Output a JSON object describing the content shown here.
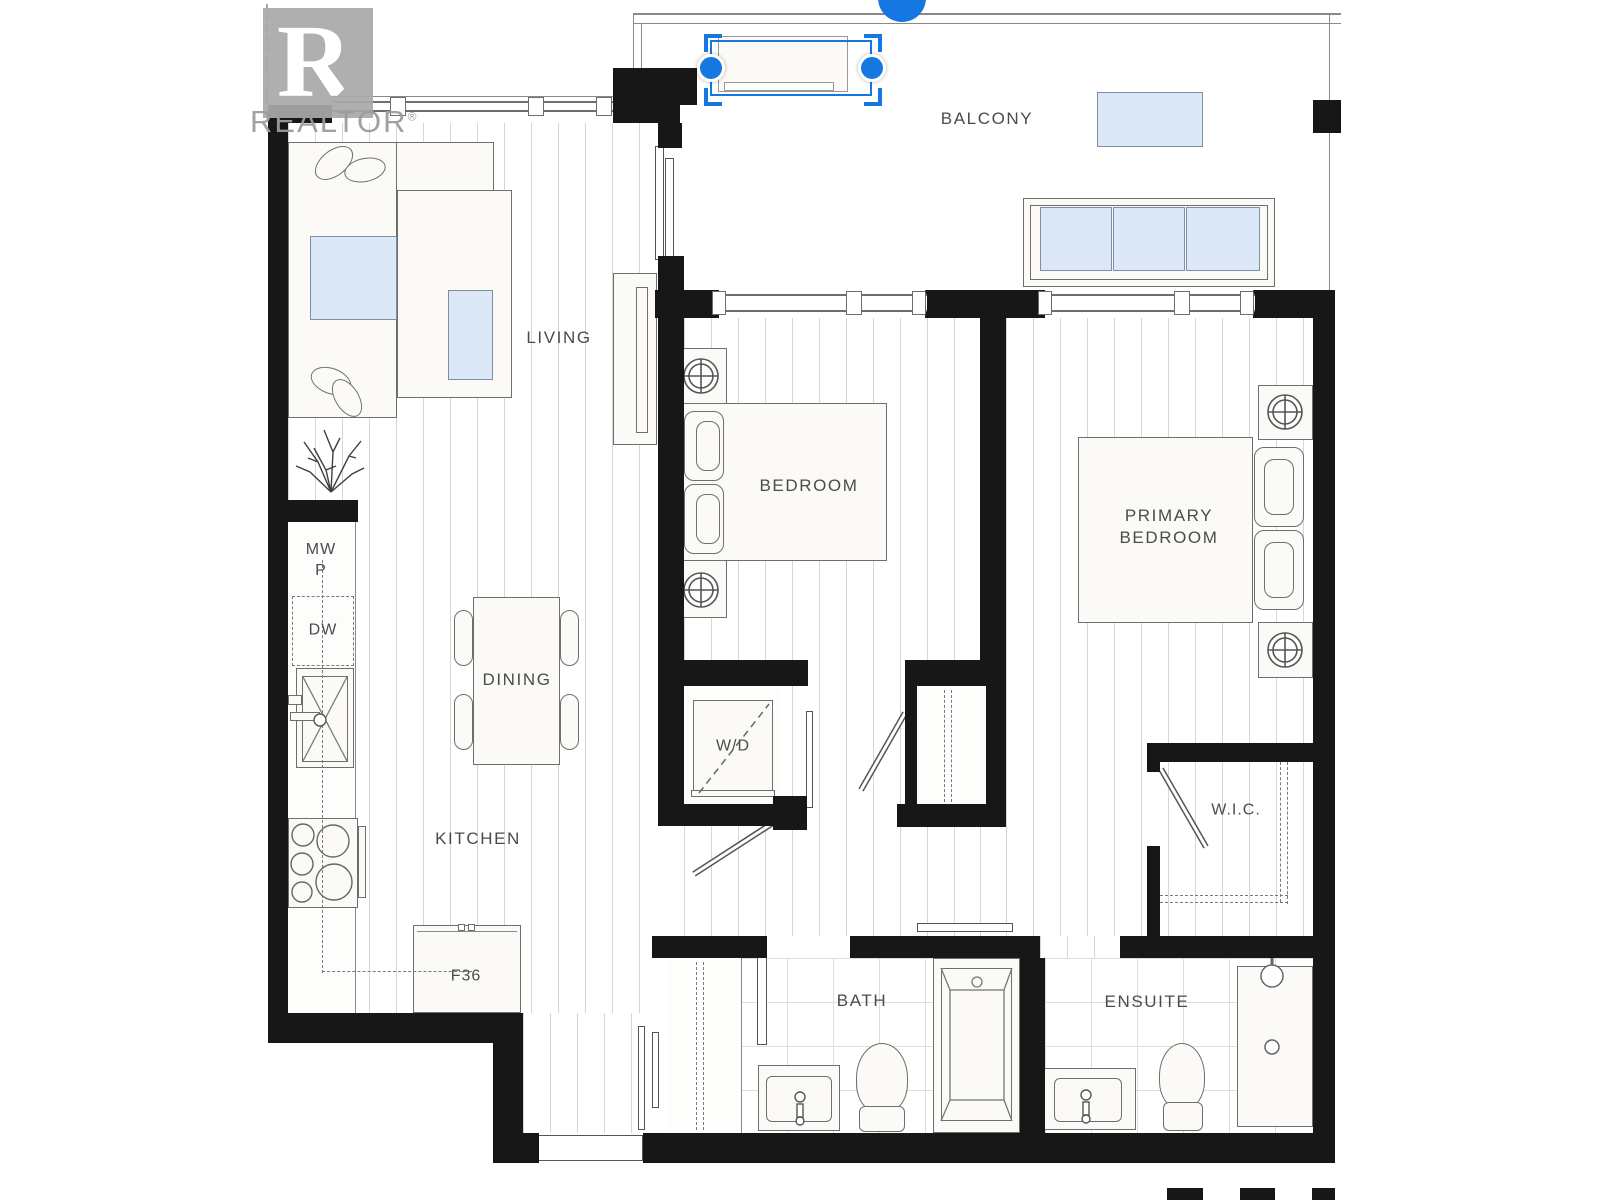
{
  "watermark": {
    "logo_letter": "R",
    "brand": "REALTOR",
    "reg_mark": "®"
  },
  "selection": {
    "accent_color": "#1577e0",
    "handles": [
      "rotate-handle",
      "resize-handle-left",
      "resize-handle-right"
    ]
  },
  "rooms": {
    "balcony": {
      "label": "BALCONY"
    },
    "living": {
      "label": "LIVING"
    },
    "dining": {
      "label": "DINING"
    },
    "kitchen": {
      "label": "KITCHEN"
    },
    "bedroom": {
      "label": "BEDROOM"
    },
    "primary": {
      "label": "PRIMARY\nBEDROOM"
    },
    "laundry": {
      "label": "W/D"
    },
    "wic": {
      "label": "W.I.C."
    },
    "bath": {
      "label": "BATH"
    },
    "ensuite": {
      "label": "ENSUITE"
    }
  },
  "fixtures": {
    "microwave_pantry": {
      "label": "MW\nP"
    },
    "dishwasher": {
      "label": "DW"
    },
    "fridge": {
      "label": "F36"
    }
  },
  "colors": {
    "wall": "#171717",
    "glass_fill": "#dce8f7",
    "selection_accent": "#1577e0",
    "floor_line": "#d6d6d6",
    "label_text": "#4b4b4b",
    "watermark_gray": "#9c9c9c"
  }
}
